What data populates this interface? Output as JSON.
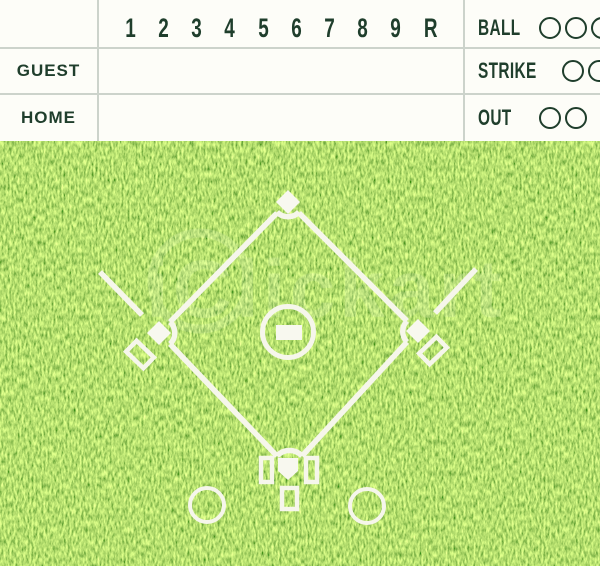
{
  "scoreboard": {
    "innings": [
      "1",
      "2",
      "3",
      "4",
      "5",
      "6",
      "7",
      "8",
      "9",
      "R"
    ],
    "teams": [
      {
        "label": "GUEST"
      },
      {
        "label": "HOME"
      }
    ],
    "counters": [
      {
        "label": "BALL",
        "circles": 3
      },
      {
        "label": "STRIKE",
        "circles": 2
      },
      {
        "label": "OUT",
        "circles": 2
      }
    ],
    "colors": {
      "text": "#1f3e2c",
      "grid_line": "#ccd3cb",
      "background": "#fdfdf8"
    }
  },
  "field": {
    "watermark": "iClickart",
    "colors": {
      "grass": "#79b42c",
      "markings": "#f6f6eb"
    }
  }
}
